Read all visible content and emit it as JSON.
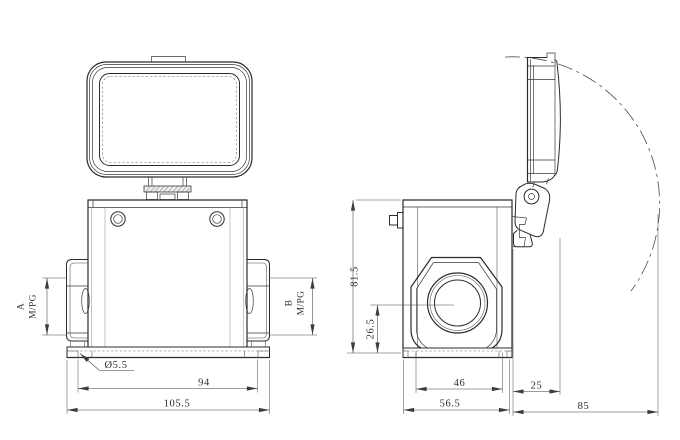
{
  "drawing": {
    "kind": "two-view engineering drawing of a heavy-duty rectangular connector housing with hinged cover",
    "background": "#ffffff",
    "line_color": "#2b2b2b",
    "dim_color": "#3c3c3c"
  },
  "front": {
    "entry_a_label": "A",
    "entry_a_thread": "M/PG",
    "entry_b_label": "B",
    "entry_b_thread": "M/PG",
    "hole_dia": "Ø5.5",
    "hole_pitch": "94",
    "overall_width": "105.5"
  },
  "side": {
    "overall_height": "81.5",
    "gland_center_height": "26.5",
    "foot_width": "46",
    "overall_depth": "56.5",
    "latch_offset": "25",
    "cover_swing": "85"
  }
}
